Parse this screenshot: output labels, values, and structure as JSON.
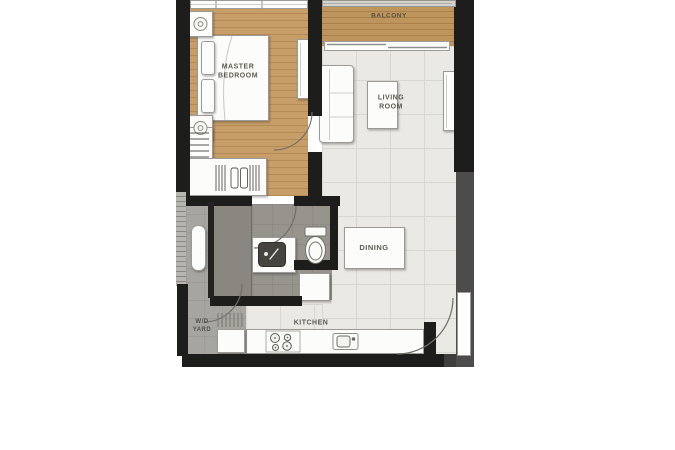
{
  "plan": {
    "type": "apartment-floor-plan",
    "rooms": {
      "master_bedroom": {
        "label": "MASTER\nBEDROOM"
      },
      "balcony": {
        "label": "BALCONY"
      },
      "living_room": {
        "label": "LIVING\nROOM"
      },
      "dining": {
        "label": "DINING"
      },
      "kitchen": {
        "label": "KITCHEN"
      },
      "wd_yard": {
        "label": "W/D\nYARD"
      }
    },
    "fixtures": {
      "bed": "double-bed",
      "nightstands": "nightstand-with-lamp",
      "wardrobe": "wardrobe-hanging-clothes",
      "dresser": "dresser",
      "sofa": "sofa",
      "coffee_table": "coffee-table",
      "tv_console": "tv-console",
      "dining_table": "dining-table-4-chairs",
      "toilet": "toilet",
      "vanity": "vanity-sink",
      "shower": "shower-area",
      "water_heater": "water-heater",
      "washer": "washer",
      "stove": "cooktop-stove",
      "kitchen_sink": "kitchen-sink",
      "fridge": "refrigerator",
      "balcony_door": "sliding-door",
      "doors": "swing-door-arcs"
    }
  },
  "colors": {
    "wall_black": "#1d1d1c",
    "wall_gray": "#4d4c4a",
    "wood_floor": "#c79e68",
    "wood_plank_line": "#b48b55",
    "balcony_wood": "#bf955e",
    "tile_floor": "#eae9e5",
    "tile_line": "#d8d7d1",
    "bath_floor": "#96948d",
    "shower_floor": "#898780",
    "yard_floor": "#a7a59f",
    "furniture_fill": "#fcfcfa",
    "furniture_line": "#9b9a96",
    "label_text": "#47453e",
    "arc_line": "#6f6e69"
  }
}
